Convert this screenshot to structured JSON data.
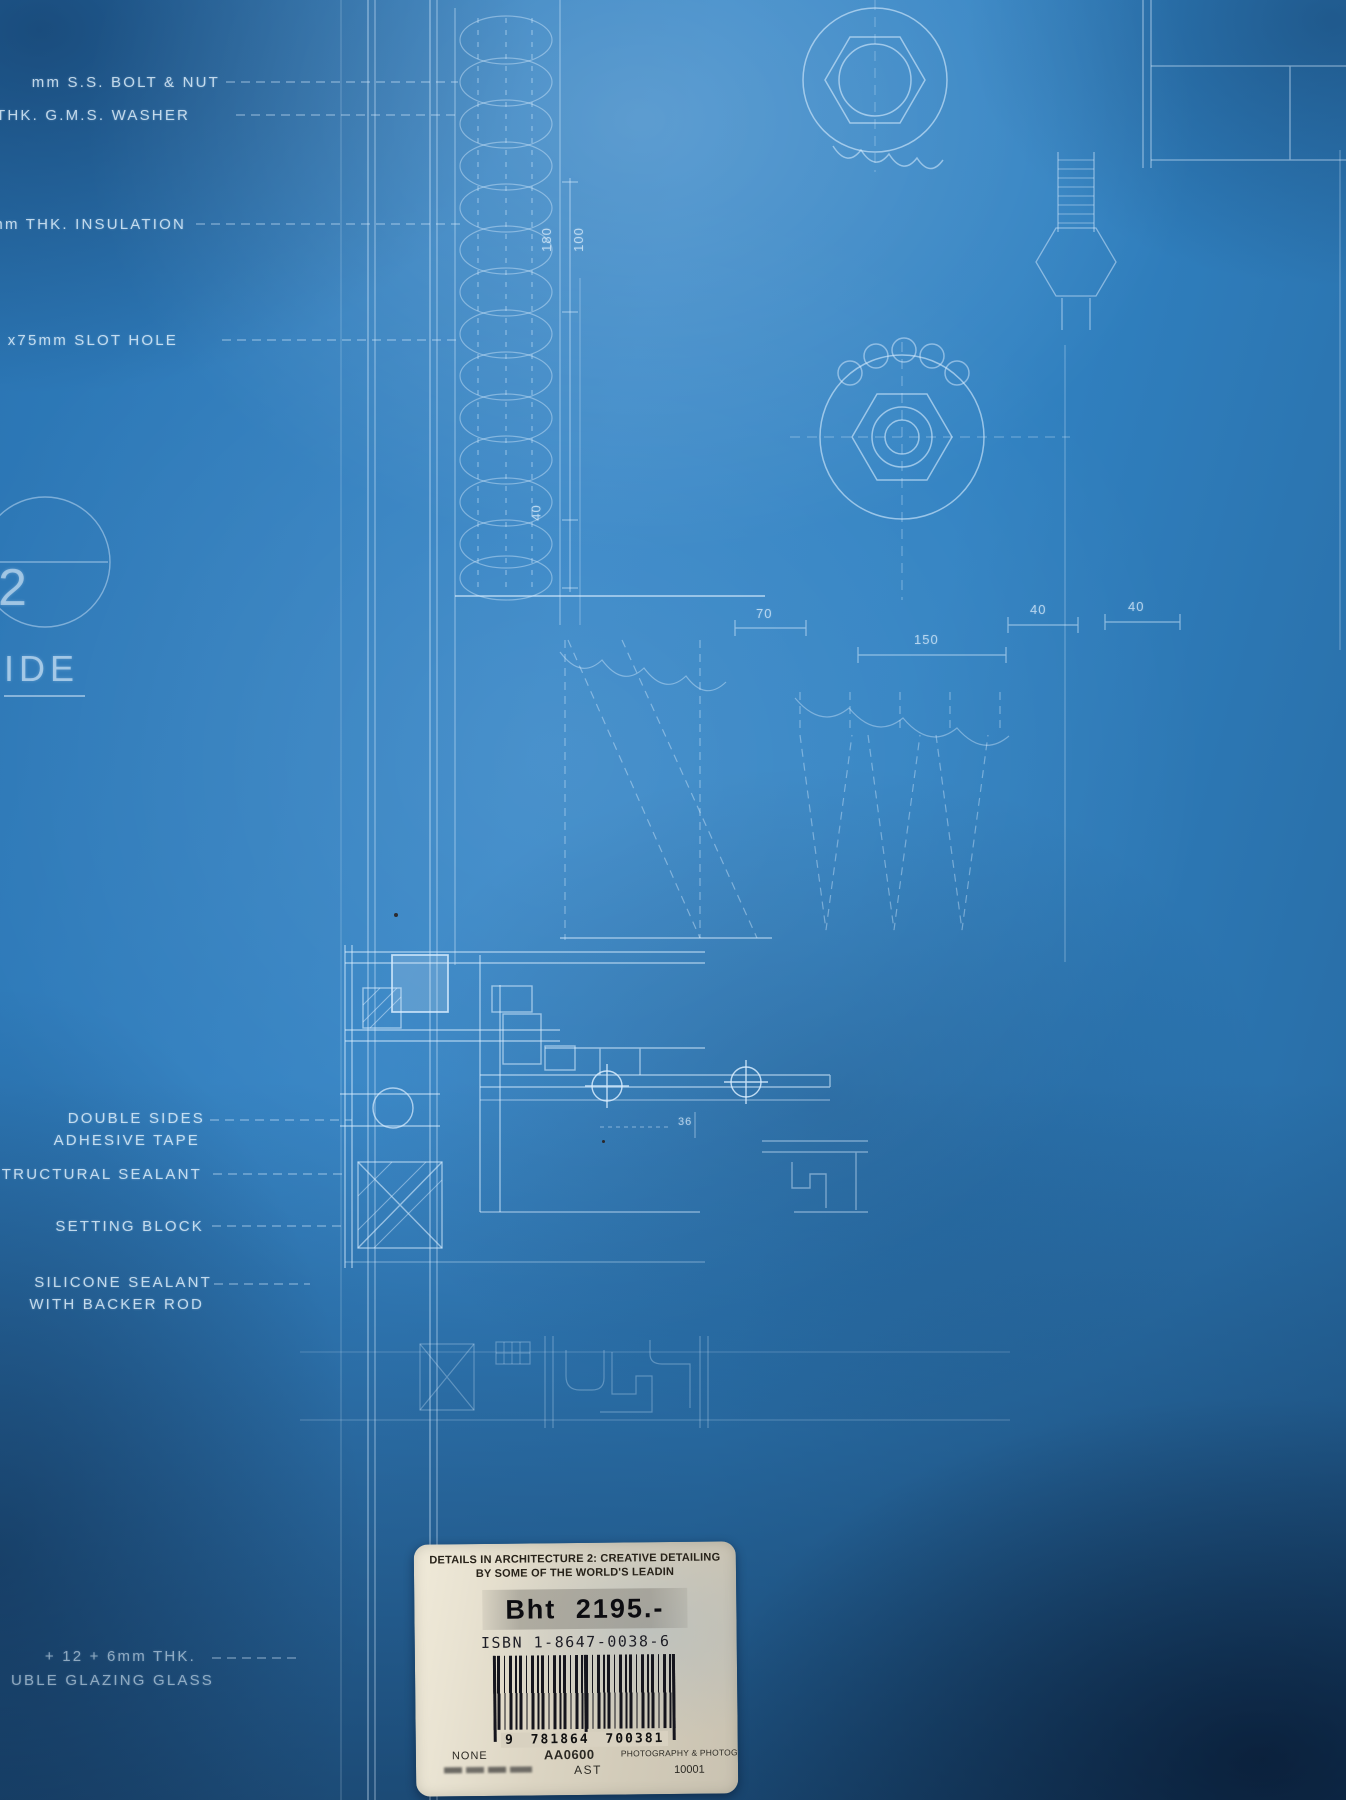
{
  "blueprint": {
    "labels": {
      "bolt_nut": "mm S.S. BOLT & NUT",
      "washer": "THK. G.M.S. WASHER",
      "insulation": "mm THK. INSULATION",
      "slot_hole": "x75mm SLOT HOLE",
      "detail_number": "2",
      "side": "IDE",
      "double_sides_1": "DOUBLE SIDES",
      "double_sides_2": "ADHESIVE TAPE",
      "structural_sealant": "TRUCTURAL SEALANT",
      "setting_block": "SETTING BLOCK",
      "silicone_1": "SILICONE SEALANT",
      "silicone_2": "WITH BACKER ROD",
      "glazing_1": "+ 12 + 6mm THK.",
      "glazing_2": "UBLE GLAZING GLASS"
    },
    "dimensions": {
      "d180": "180",
      "d100": "100",
      "d40v": "40",
      "d70": "70",
      "d150": "150",
      "d40a": "40",
      "d40b": "40",
      "d36": "36"
    },
    "colors": {
      "cover_blue": "#3182c2",
      "line_white": "#dbeeff"
    }
  },
  "sticker": {
    "title_line1": "DETAILS IN ARCHITECTURE 2: CREATIVE DETAILING",
    "title_line2": "BY SOME OF THE WORLD'S LEADIN",
    "price": "Bht 2195.-",
    "isbn": "ISBN 1-8647-0038-6",
    "barcode_digits": "9 781864 700381",
    "footer": {
      "none": "NONE",
      "code": "AA0600",
      "category": "PHOTOGRAPHY & PHOTOGRAPHS",
      "ast": "AST",
      "number": "10001"
    },
    "colors": {
      "sticker_beige": "#ddd6c5",
      "price_band_grey": "#a8a499",
      "barcode_black": "#15151d"
    }
  }
}
